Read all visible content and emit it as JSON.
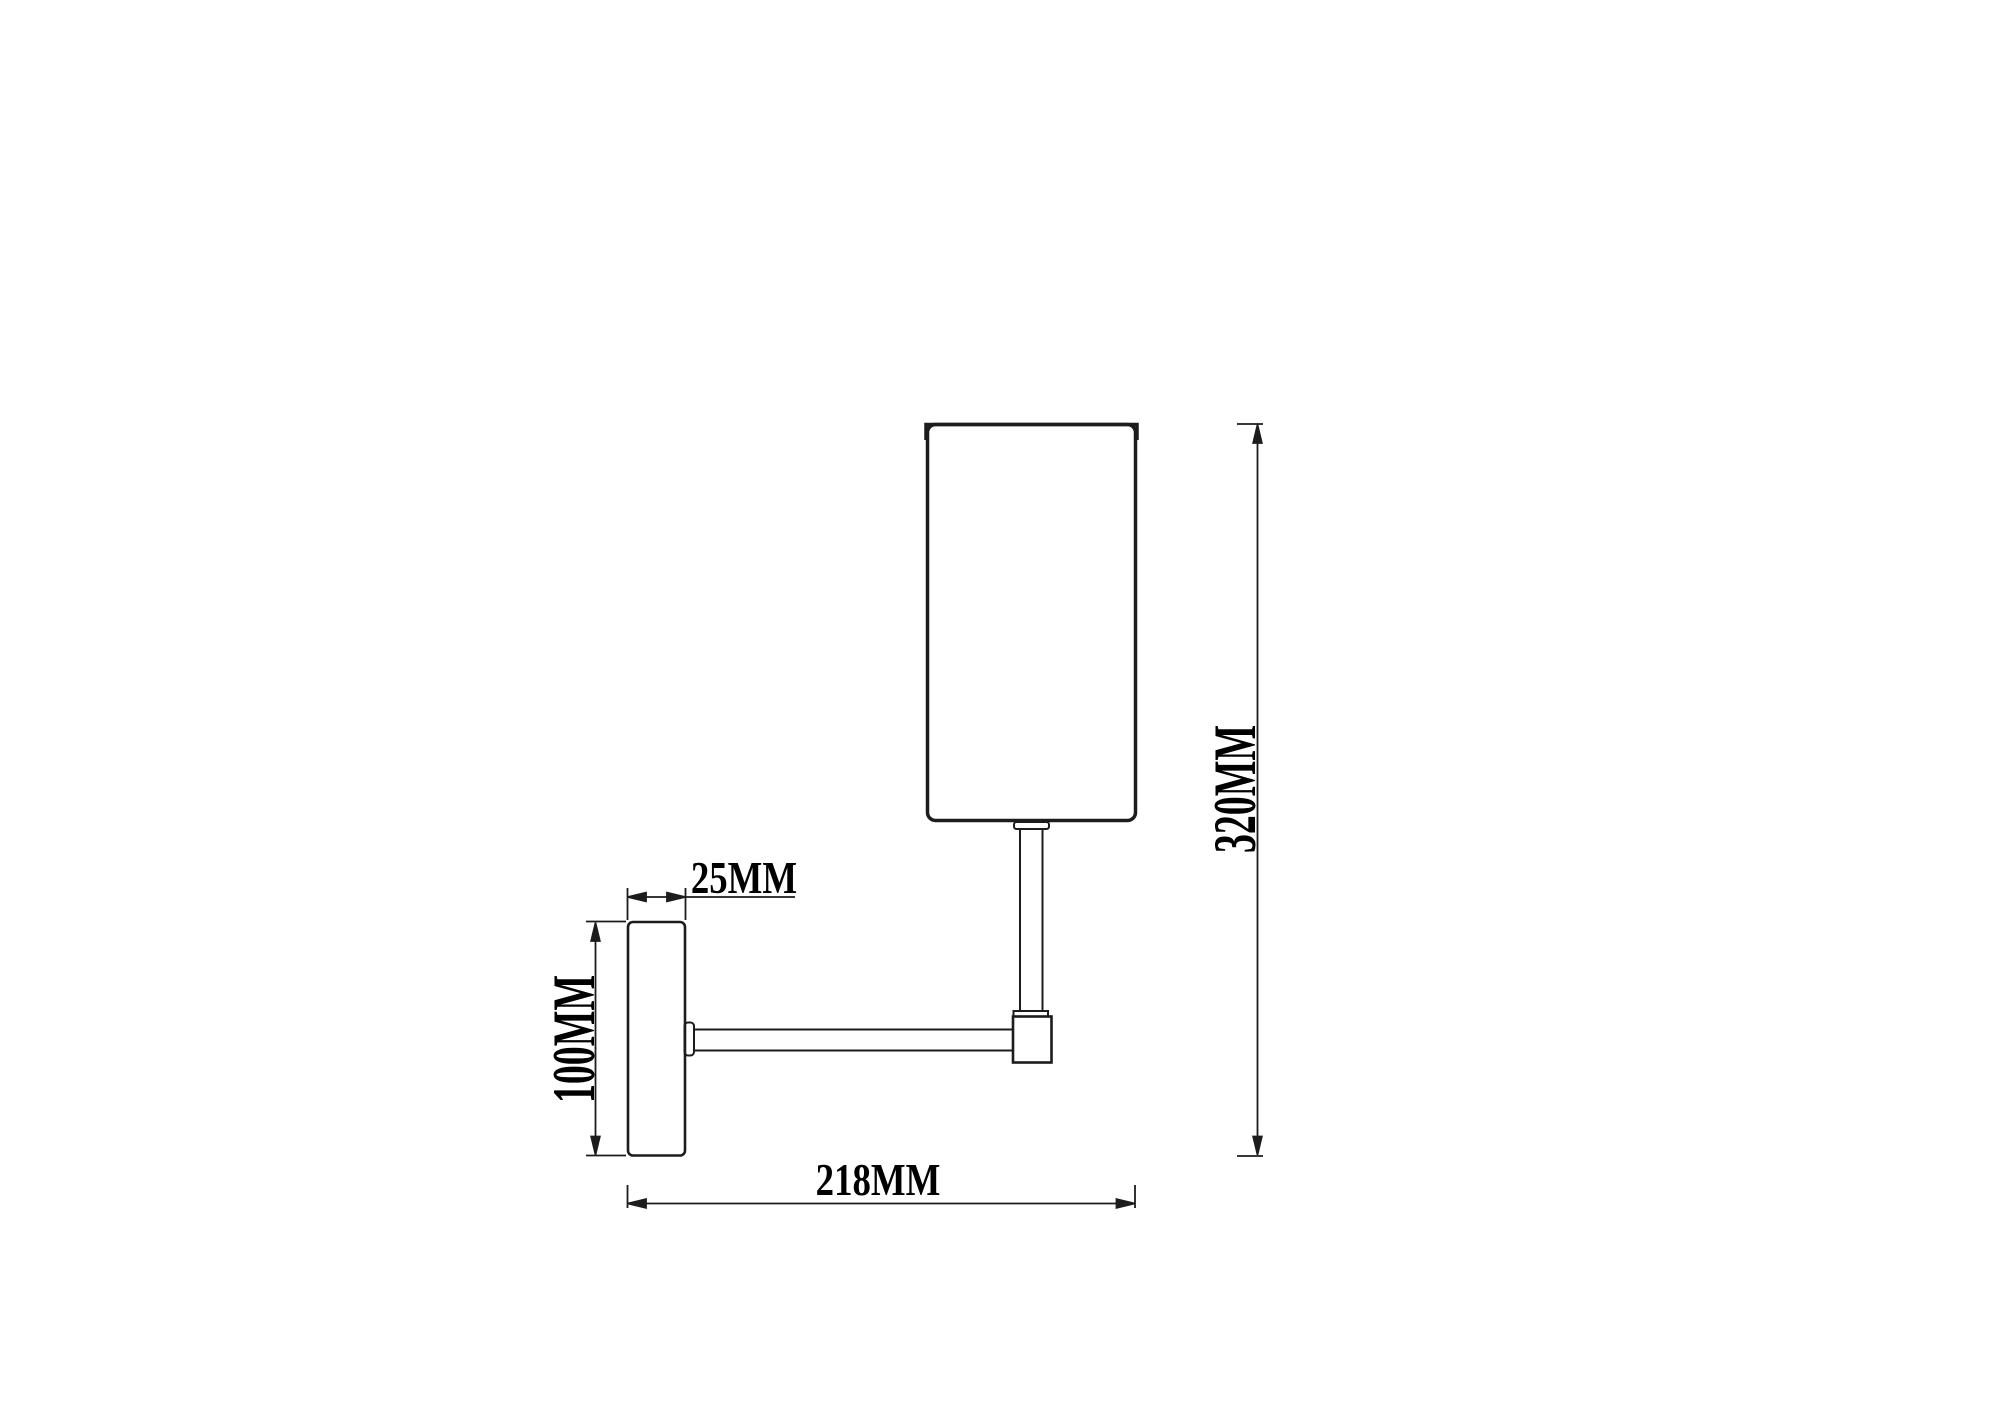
{
  "drawing": {
    "background_color": "#ffffff",
    "line_color": "#1c1c1c",
    "text_color": "#000000",
    "type": "wall-lamp-dimension-drawing"
  },
  "labels": {
    "plate_depth": "25MM",
    "plate_height": "100MM",
    "total_width": "218MM",
    "total_height": "320MM"
  }
}
